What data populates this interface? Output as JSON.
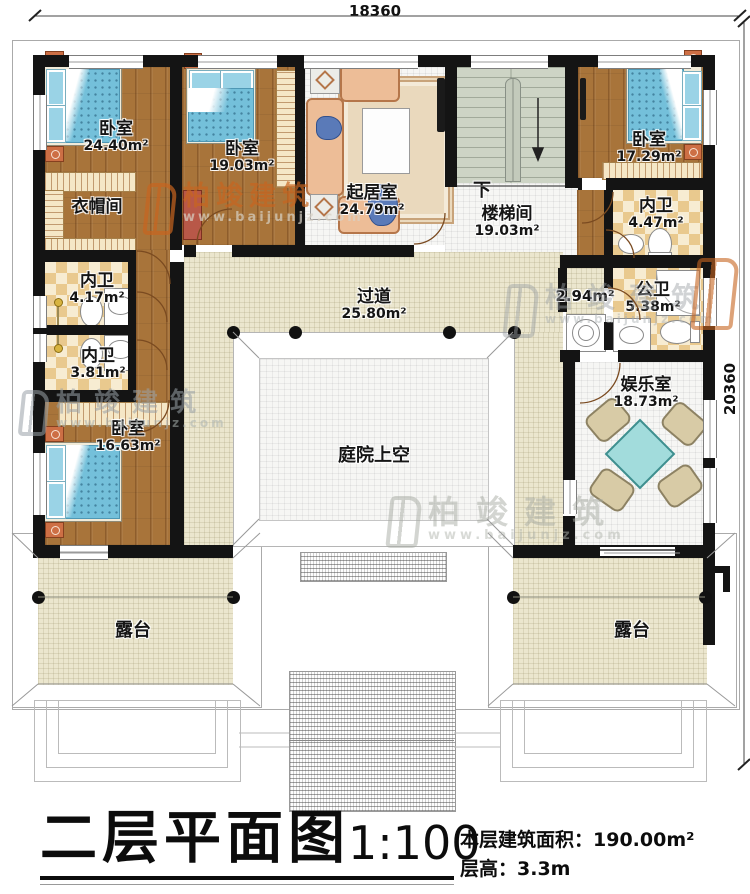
{
  "title_block": {
    "title": "二层平面图",
    "scale": "1:100",
    "area": "本层建筑面积：190.00m²",
    "floor_height": "层高：3.3m"
  },
  "dimensions": {
    "width": "18360",
    "height": "20360"
  },
  "watermark": {
    "brand": "柏竣建筑",
    "url": "www.baijunjz.com"
  },
  "rooms": {
    "bedroom_tl": {
      "name": "卧室",
      "area": "24.40m²"
    },
    "bedroom_tm": {
      "name": "卧室",
      "area": "19.03m²"
    },
    "living": {
      "name": "起居室",
      "area": "24.79m²"
    },
    "stairwell": {
      "name": "楼梯间",
      "area": "19.03m²",
      "direction": "下"
    },
    "bedroom_tr": {
      "name": "卧室",
      "area": "17.29m²"
    },
    "bath_tr": {
      "name": "内卫",
      "area": "4.47m²"
    },
    "cloakroom": {
      "name": "衣帽间"
    },
    "bath_l1": {
      "name": "内卫",
      "area": "4.17m²"
    },
    "bath_l2": {
      "name": "内卫",
      "area": "3.81m²"
    },
    "bedroom_bl": {
      "name": "卧室",
      "area": "16.63m²"
    },
    "corridor": {
      "name": "过道",
      "area": "25.80m²"
    },
    "lobby": {
      "area": "2.94m²"
    },
    "bath_public": {
      "name": "公卫",
      "area": "5.38m²"
    },
    "entertainment": {
      "name": "娱乐室",
      "area": "18.73m²"
    },
    "courtyard": {
      "name": "庭院上空"
    },
    "terrace_left": {
      "name": "露台"
    },
    "terrace_right": {
      "name": "露台"
    }
  },
  "colors": {
    "wall": "#141414",
    "wood": "#a8743a",
    "corridor": "#ebe6ce",
    "tile": "#e9c98e",
    "stairs": "#cdd4c5",
    "bed": "#74c0da",
    "accent": "#cd6f45",
    "table": "#a2dcdc",
    "watermark_orange": "#c8651f"
  }
}
